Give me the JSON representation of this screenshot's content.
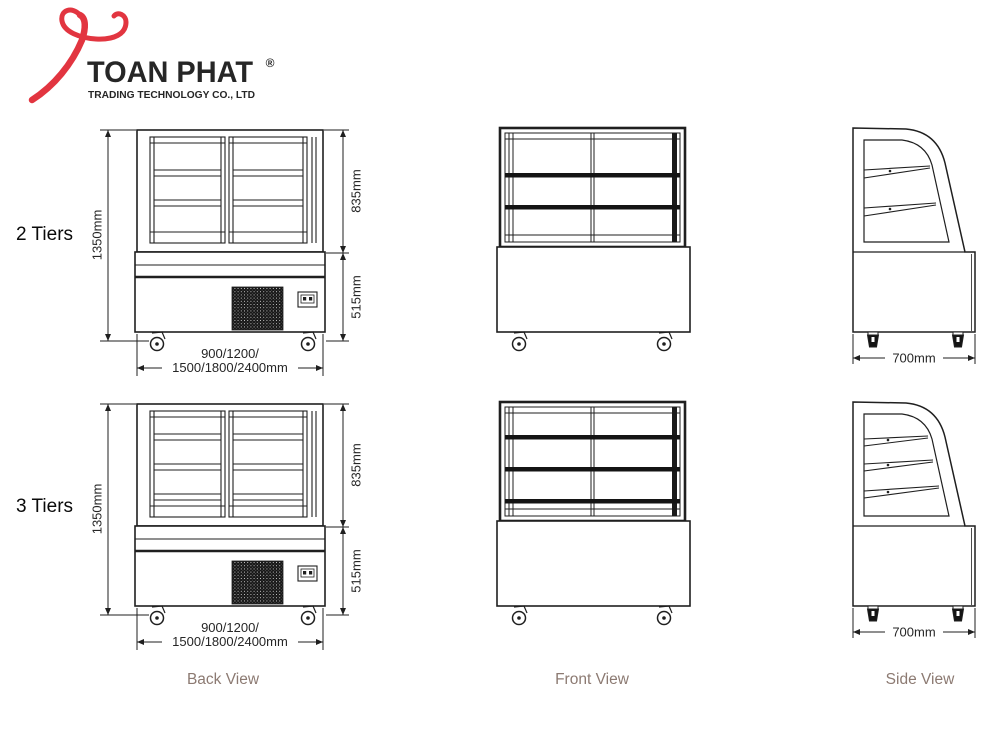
{
  "header": {
    "logo": {
      "brand": "TOAN PHAT",
      "registered": "®",
      "subtitle": "TRADING TECHNOLOGY CO., LTD",
      "mark_color": "#e23540",
      "text_color": "#1b86c8"
    }
  },
  "rows": [
    {
      "label": "2 Tiers",
      "tiers": 2
    },
    {
      "label": "3 Tiers",
      "tiers": 3
    }
  ],
  "dimensions": {
    "total_height": "1350mm",
    "display_height": "835mm",
    "base_height": "515mm",
    "width_line1": "900/1200/",
    "width_line2": "1500/1800/2400mm",
    "depth": "700mm"
  },
  "view_labels": {
    "back": "Back View",
    "front": "Front View",
    "side": "Side View"
  },
  "colors": {
    "line": "#1f1f1f",
    "view_label": "#8c7a72",
    "background": "#ffffff"
  }
}
